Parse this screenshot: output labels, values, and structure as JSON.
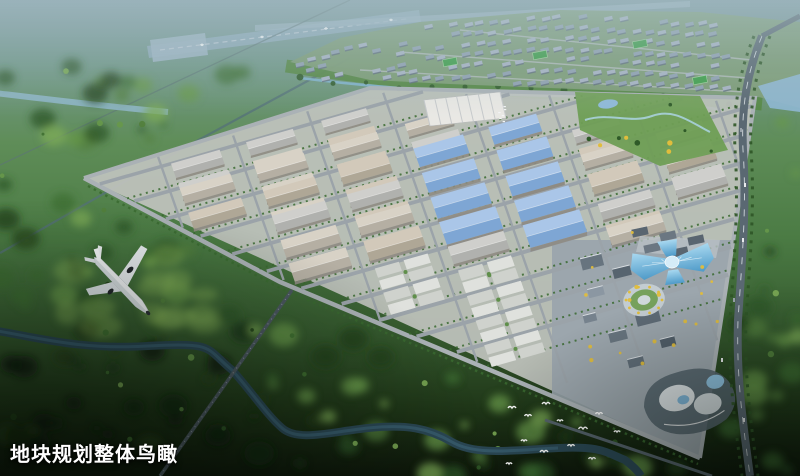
{
  "caption": {
    "text": "地块规划整体鸟瞰"
  },
  "palette": {
    "caption_color": "#ffffff",
    "sky_haze": "#aac3cb",
    "forest_green": "#3f6f31",
    "forest_dark": "#16280f",
    "meadow_green": "#86b159",
    "ground_gray": "#bfc3bd",
    "commercial_ground": "#9aa5ad",
    "road_gray": "#9ba3a9",
    "boundary_road": "#aab1b5",
    "warehouse_roof_light": "#d8d2c6",
    "warehouse_roof_shade": "#b5afa3",
    "warehouse_wall": "#8e8b83",
    "blue_roof_light": "#aac6e8",
    "blue_roof": "#7ea6d4",
    "glass_blue_light": "#a8d8f0",
    "glass_blue": "#4e9ac8",
    "runway_gray": "#8ea9b9",
    "highway_gray": "#5a6872",
    "canal_blue": "#7fb2cc",
    "river_blue": "#2a4754",
    "upper_river_blue": "#8fb6c9",
    "lake_blue": "#8fb9d8",
    "residential_wall": "#a6b2c2",
    "residential_base": "#7d9c76",
    "pitch_green": "#3f9e4a",
    "accent_yellow": "#e0bd3c",
    "tree_green": "#3a6a30",
    "plane_white": "#f2f4f6",
    "bird_white": "#ffffff"
  }
}
